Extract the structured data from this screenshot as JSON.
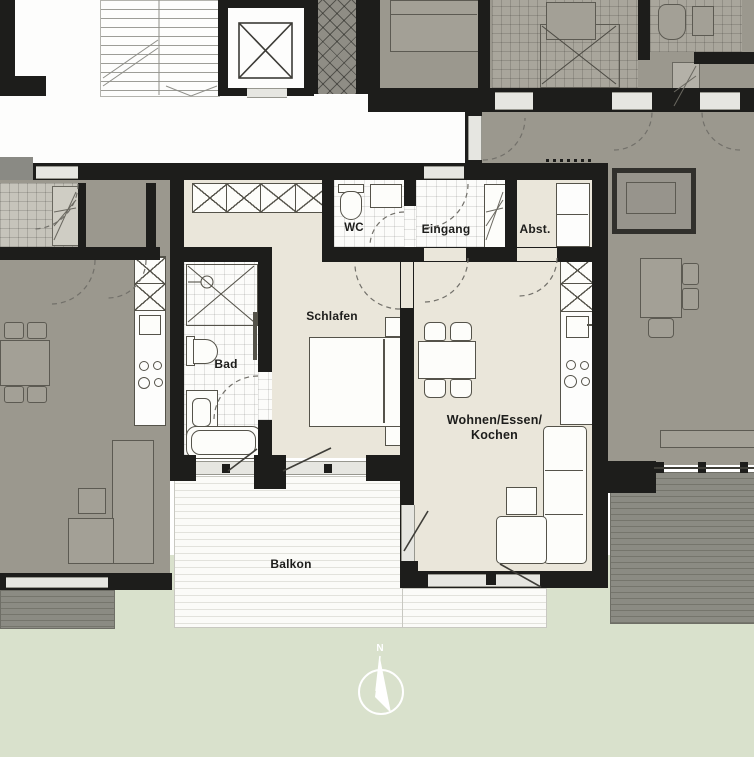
{
  "palette": {
    "wall": "#1d1d1b",
    "mfloor": "#eae6da",
    "nfloor": "#9b988e",
    "nfloor-dark": "#8a8a84",
    "lawn": "#d9e1cc",
    "outline": "#55534a",
    "label": "#1d1d1b"
  },
  "plan": {
    "rooms": {
      "wc": {
        "label": "WC"
      },
      "eingang": {
        "label": "Eingang"
      },
      "abst": {
        "label": "Abst."
      },
      "schlafen": {
        "label": "Schlafen"
      },
      "bad": {
        "label": "Bad"
      },
      "wohnen": {
        "label_line1": "Wohnen/Essen/",
        "label_line2": "Kochen"
      },
      "balkon": {
        "label": "Balkon"
      }
    },
    "compass": {
      "north_label": "N"
    }
  }
}
